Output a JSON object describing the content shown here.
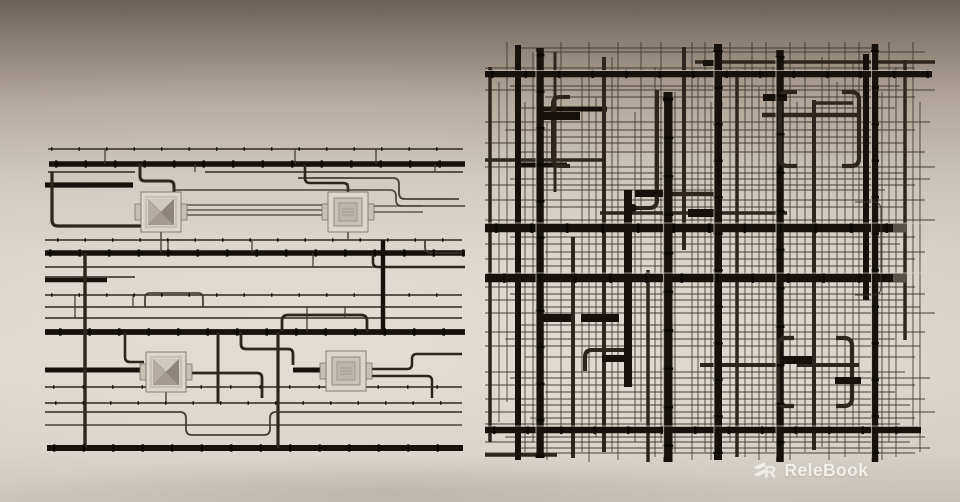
{
  "watermark": {
    "logo_icon": "relebook-r-icon",
    "logo_letter": "R",
    "brand": "ReleBook",
    "suffix": ".com"
  },
  "scene": {
    "left_panel": "ceiling-pipe-system-elevation-with-air-diffusers",
    "right_panel": "ceiling-pipe-system-grid-plan-view"
  },
  "colors": {
    "bg_top": "#6b6156",
    "bg_upper": "#b1a699",
    "bg_mid": "#d6d1c9",
    "bg_lower": "#dad5cd",
    "bg_bottom": "#c6c1b8",
    "pipe_dark": "#16110c",
    "pipe_mid": "#2e261e",
    "pipe_thin": "#3c342b",
    "pipe_ring": "#0a0704",
    "pipe_highlight": "#ddd7cd",
    "diffuser_face": "#dcd6cc",
    "diffuser_frame": "#c7c1b5",
    "diffuser_dark": "#8d8679",
    "diffuser_mid": "#b3ac9f",
    "watermark_text": "#f5f2ed",
    "watermark_dim": "#cdc8c0"
  }
}
